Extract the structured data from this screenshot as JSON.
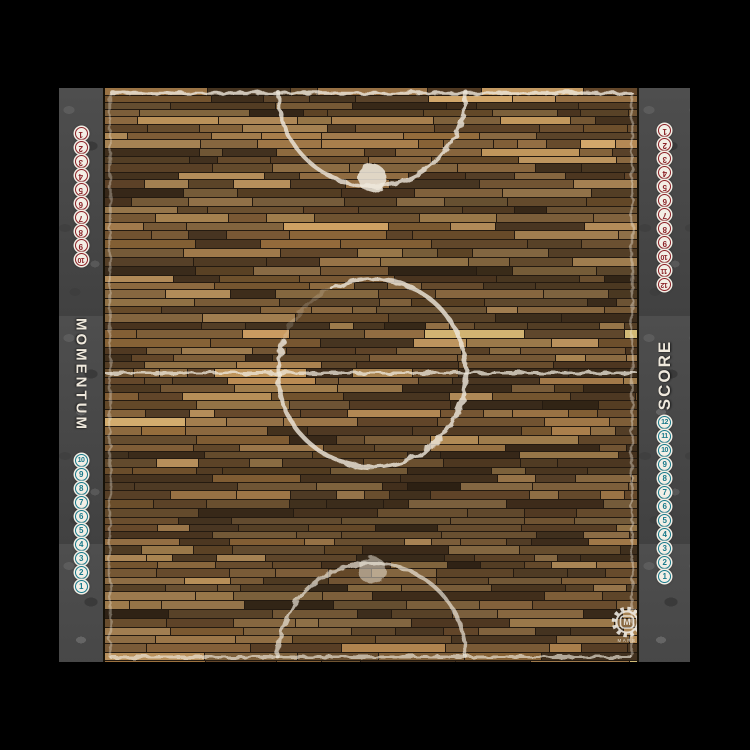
{
  "mat": {
    "left_strip": {
      "label": "MOMENTUM",
      "top_track": {
        "color_name": "red",
        "orientation": "upside-down",
        "values": [
          "1",
          "2",
          "3",
          "4",
          "5",
          "6",
          "7",
          "8",
          "9",
          "10"
        ]
      },
      "bottom_track": {
        "color_name": "teal",
        "orientation": "upright",
        "values": [
          "10",
          "9",
          "8",
          "7",
          "6",
          "5",
          "4",
          "3",
          "2",
          "1"
        ]
      }
    },
    "right_strip": {
      "label": "SCORE",
      "top_track": {
        "color_name": "red",
        "orientation": "upside-down",
        "values": [
          "1",
          "2",
          "3",
          "4",
          "5",
          "6",
          "7",
          "8",
          "9",
          "10",
          "11",
          "12"
        ]
      },
      "bottom_track": {
        "color_name": "teal",
        "orientation": "upright",
        "values": [
          "12",
          "11",
          "10",
          "9",
          "8",
          "7",
          "6",
          "5",
          "4",
          "3",
          "2",
          "1"
        ]
      }
    },
    "logo": {
      "letter": "M",
      "caption": "MARS"
    },
    "colors": {
      "red": "#8b2127",
      "teal": "#17798a",
      "pip_bg": "#f3efe6",
      "line": "#efe9dd",
      "stone": "#474747",
      "background": "#000000"
    }
  }
}
